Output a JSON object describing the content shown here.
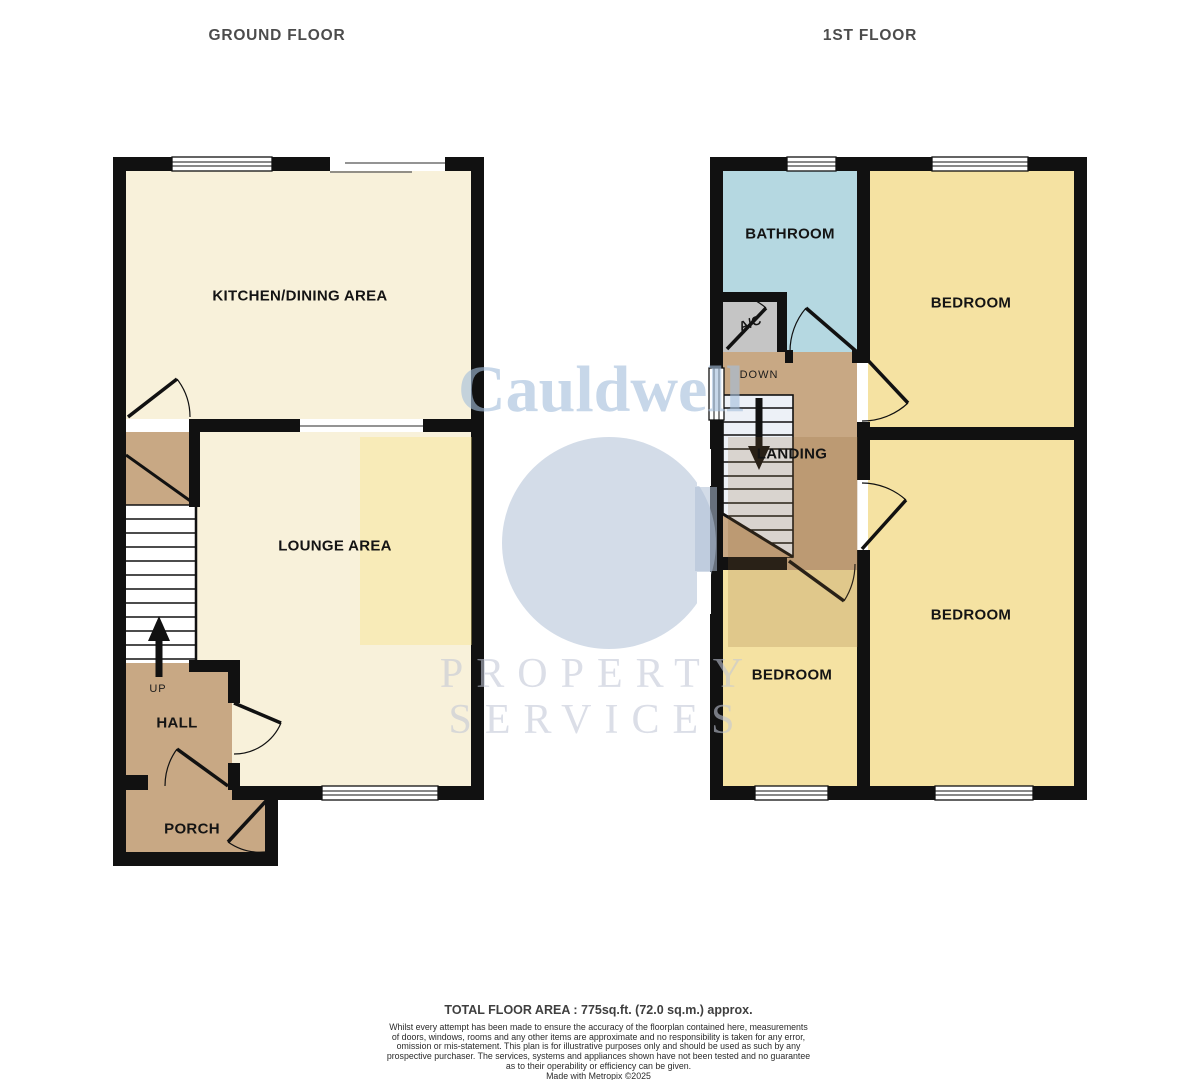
{
  "ground_floor": {
    "title": "GROUND FLOOR",
    "rooms": {
      "kitchen": "KITCHEN/DINING AREA",
      "lounge": "LOUNGE AREA",
      "hall": "HALL",
      "porch": "PORCH"
    },
    "stairs_label": "UP"
  },
  "first_floor": {
    "title": "1ST FLOOR",
    "rooms": {
      "bathroom": "BATHROOM",
      "bedroom_top": "BEDROOM",
      "bedroom_bottom_right": "BEDROOM",
      "bedroom_bottom_left": "BEDROOM",
      "landing": "LANDING",
      "ac": "A/C"
    },
    "stairs_label": "DOWN"
  },
  "watermark": {
    "name": "Cauldwell",
    "tagline1": "PROPERTY",
    "tagline2": "SERVICES"
  },
  "footer": {
    "total_area": "TOTAL FLOOR AREA : 775sq.ft. (72.0 sq.m.) approx.",
    "disclaimer_lines": [
      "Whilst every attempt has been made to ensure the accuracy of the floorplan contained here, measurements",
      "of doors, windows, rooms and any other items are approximate and no responsibility is taken for any error,",
      "omission or mis-statement. This plan is for illustrative purposes only and should be used as such by any",
      "prospective purchaser. The services, systems and appliances shown have not been tested and no guarantee",
      "as to their operability or efficiency can be given."
    ],
    "credit": "Made with Metropix ©2025"
  },
  "colors": {
    "wall": "#111111",
    "room_cream": "#f8f1da",
    "room_yellow": "#f5e2a2",
    "bathroom_blue": "#b5d8e1",
    "hall_tan": "#c8a884",
    "ac_gray": "#c5c5c5",
    "watermark_blue": "#aabed9"
  }
}
